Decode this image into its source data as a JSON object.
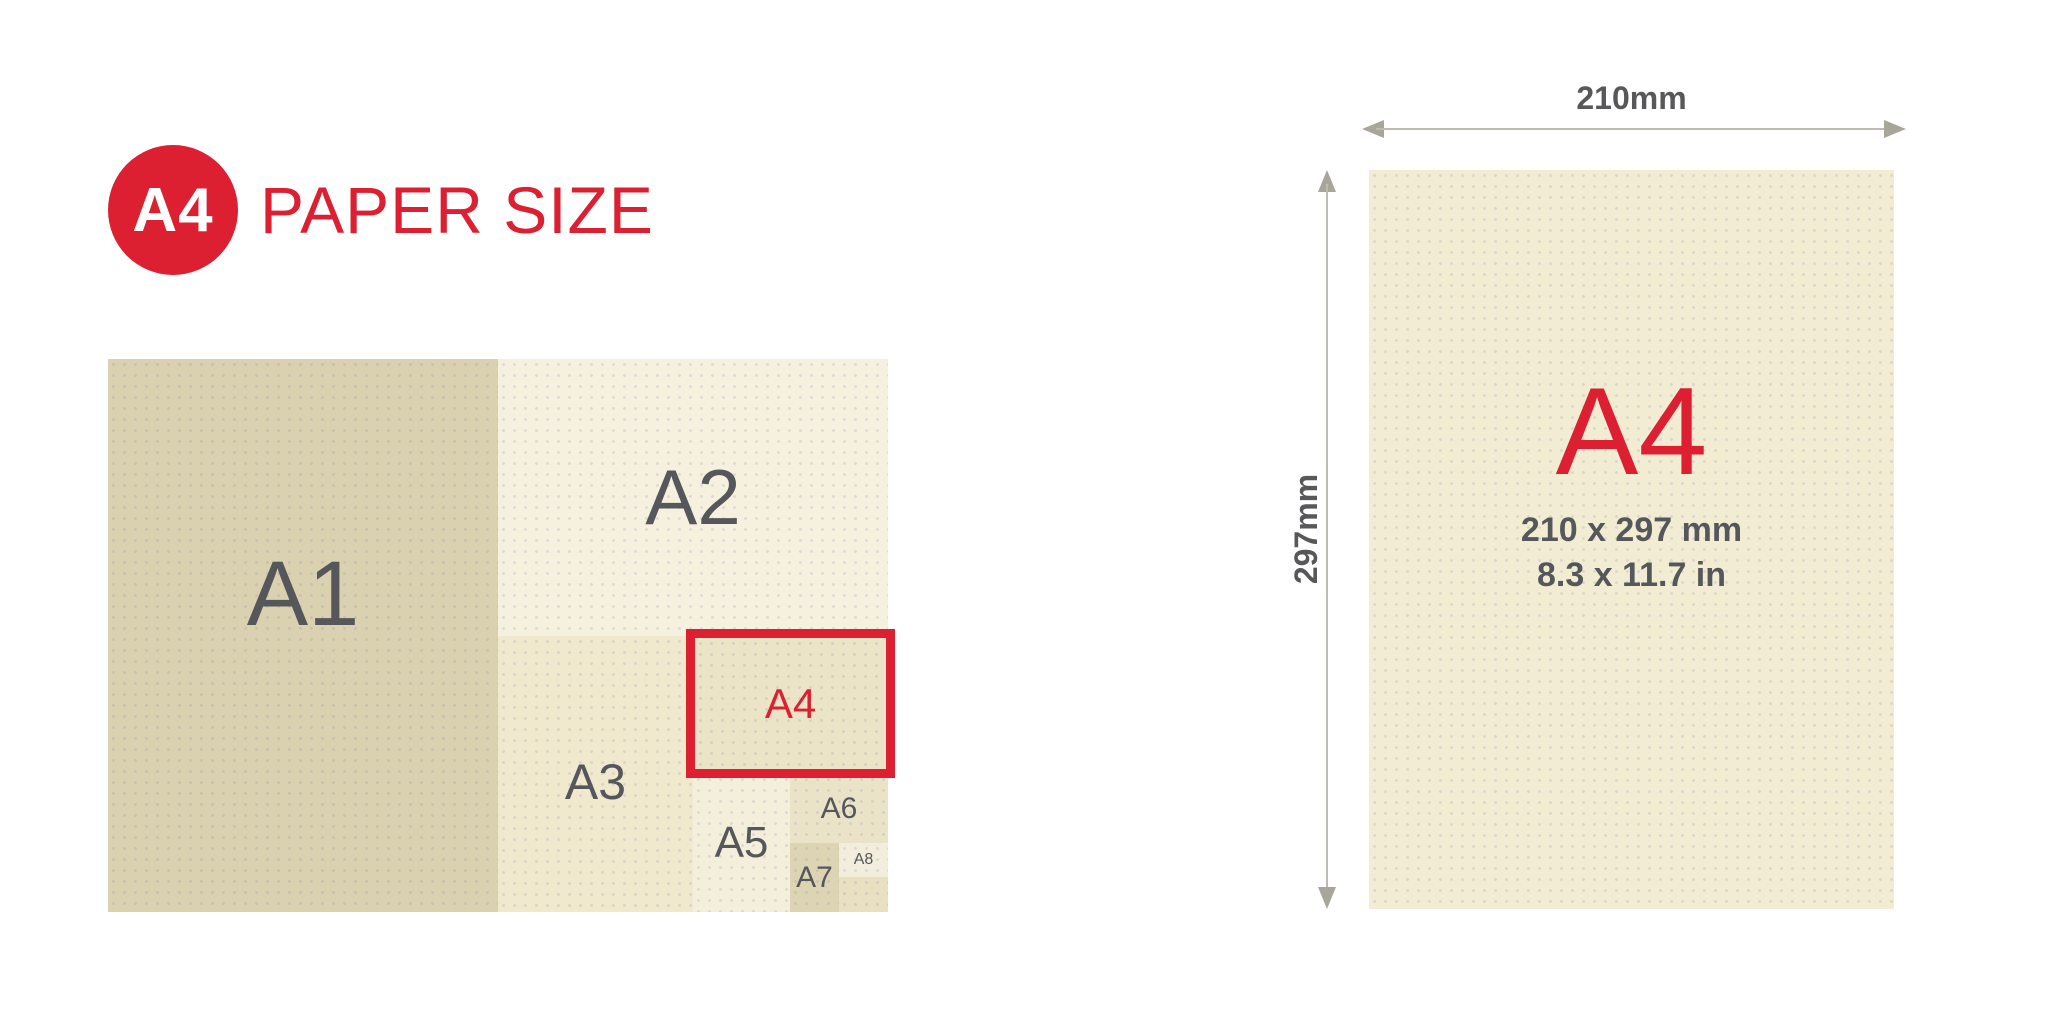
{
  "header": {
    "badge": "A4",
    "title": "PAPER SIZE"
  },
  "accent_color": "#dc2032",
  "text_color": "#56575b",
  "diagram": {
    "cells": [
      {
        "label": "A1",
        "color": "#d9d1af"
      },
      {
        "label": "A2",
        "color": "#f5f1de"
      },
      {
        "label": "A3",
        "color": "#f0e9ce"
      },
      {
        "label": "A4",
        "color": "#ece4c6",
        "highlight": true
      },
      {
        "label": "A5",
        "color": "#f4efda"
      },
      {
        "label": "A6",
        "color": "#ebe3c8"
      },
      {
        "label": "A7",
        "color": "#dcd4b2"
      },
      {
        "label": "A8",
        "color": "#f2eedb"
      }
    ],
    "leftover_color": "#e8e0c0"
  },
  "detail": {
    "size_label": "A4",
    "dimensions_mm": "210 x 297 mm",
    "dimensions_in": "8.3 x 11.7 in",
    "width_label": "210mm",
    "height_label": "297mm",
    "paper_color": "#f2ecd2"
  }
}
